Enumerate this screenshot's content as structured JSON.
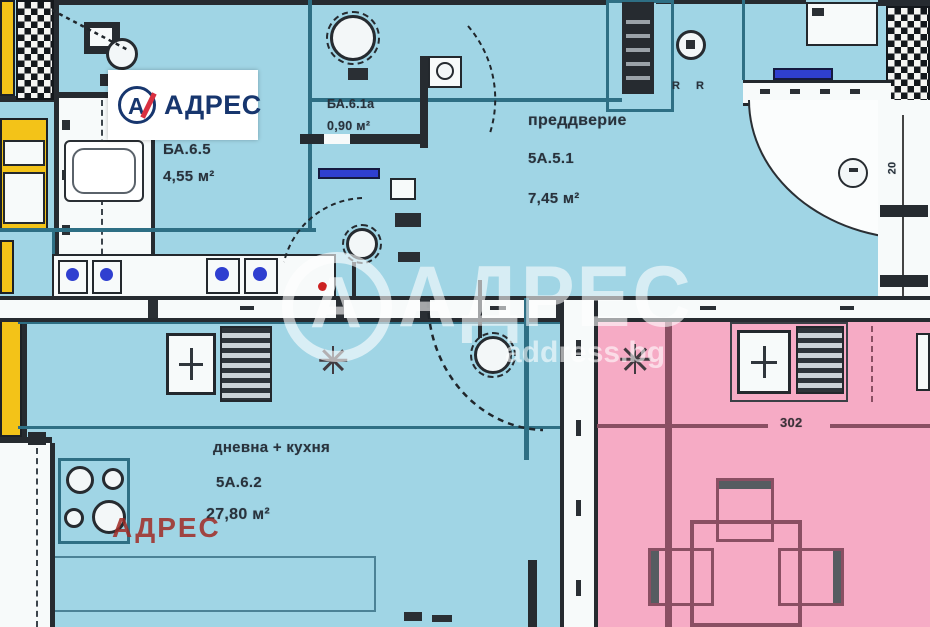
{
  "branding": {
    "logo": {
      "monogram": "А",
      "text": "АДРЕС"
    },
    "watermark": {
      "monogram": "А",
      "text": "АДРЕС",
      "site": "address.bg"
    },
    "stamp": {
      "text": "АДРЕС"
    }
  },
  "rooms": {
    "bathroom": {
      "code": "БА.6.5",
      "area": "4,55 м²"
    },
    "shaft_bathroom": {
      "code": "БА.6.1а",
      "area": "0,90 м²"
    },
    "hallway": {
      "name": "преддверие",
      "code": "5А.5.1",
      "area": "7,45 м²"
    },
    "living_kitchen": {
      "name": "дневна + кухня",
      "code": "5А.6.2",
      "area": "27,80 м²"
    }
  },
  "dimensions": {
    "pink_width": "302",
    "wall_thickness": "20",
    "outlet_left": "R",
    "outlet_right": "R"
  },
  "colors": {
    "floor_blue": "#a0d5e5",
    "floor_pink": "#f6abc5",
    "floor_yellow": "#f3c318",
    "wall_dark": "#23282d",
    "accent_blue": "#2f3fd0",
    "brand_navy": "#17366e",
    "brand_red": "#d93040"
  }
}
